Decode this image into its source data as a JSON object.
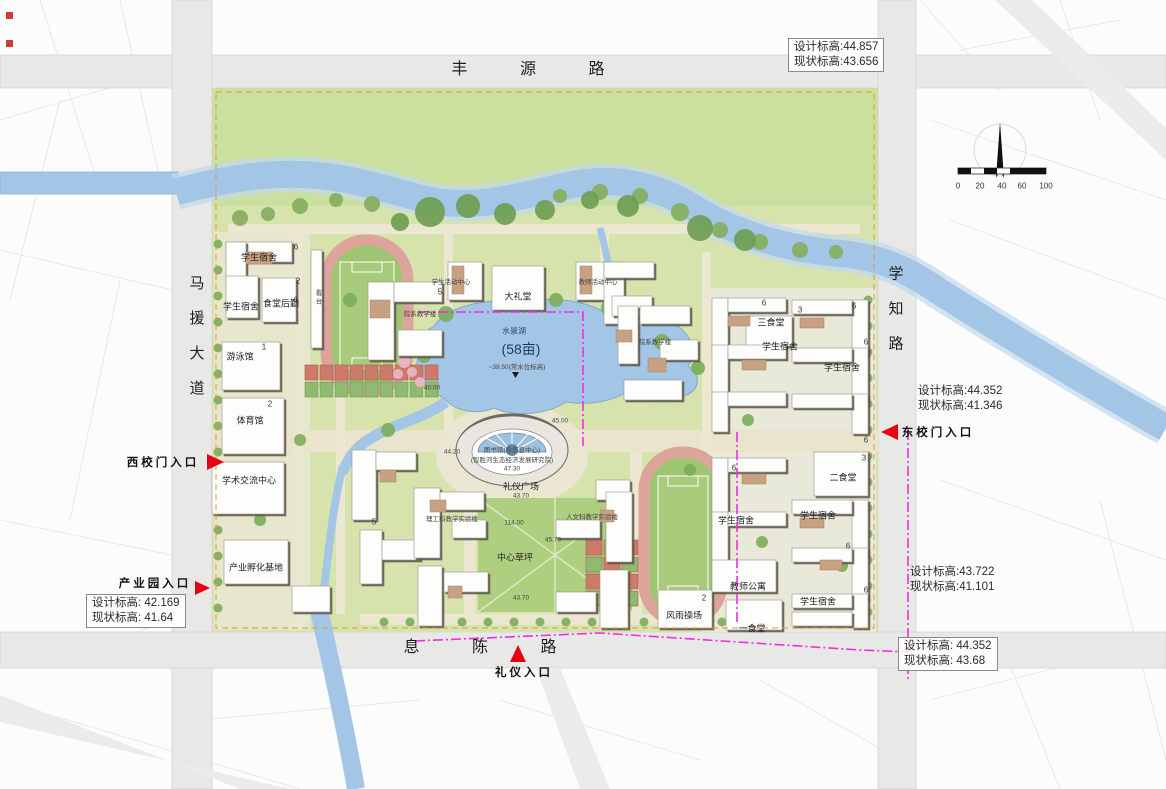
{
  "title": "校园总平面图",
  "colors": {
    "water": "#a4c6e6",
    "campus_green": "#d7e3ad",
    "lawn_green": "#cbdf9e",
    "track_red": "#dca49a",
    "field_green": "#a8cb7b",
    "building_tan": "#c8a183",
    "boundary_magenta": "#ee2fe2",
    "boundary_orange": "#e2953f",
    "arrow_red": "#e60012"
  },
  "roads": {
    "north": "丰 源 路",
    "west": "马援大道",
    "east": "学知路",
    "south": "息 陈 路"
  },
  "entrances": {
    "west": "西 校 门 入 口",
    "east": "东 校 门 入 口",
    "industry": "产 业 园 入 口",
    "ceremony": "礼 仪 入 口"
  },
  "lake": {
    "name": "水景湖",
    "area": "(58亩)",
    "level": "~39.50(常水位标高)"
  },
  "north_arrow": "north-arrow",
  "scale_ticks": [
    "0",
    "20",
    "40",
    "60",
    "100"
  ],
  "elevation_notes": [
    {
      "x": 788,
      "y": 38,
      "design": "设计标高:44.857",
      "current": "现状标高:43.656",
      "boxed": true
    },
    {
      "x": 918,
      "y": 384,
      "design": "设计标高:44.352",
      "current": "现状标高:41.346",
      "boxed": false
    },
    {
      "x": 910,
      "y": 565,
      "design": "设计标高:43.722",
      "current": "现状标高:41.101",
      "boxed": false
    },
    {
      "x": 898,
      "y": 637,
      "design": "设计标高: 44.352",
      "current": "现状标高: 43.68",
      "boxed": true
    },
    {
      "x": 86,
      "y": 594,
      "design": "设计标高: 42.169",
      "current": "现状标高: 41.64",
      "boxed": true
    }
  ],
  "map_labels": [
    {
      "name": "road-label-fengyuan",
      "text": "丰 源 路",
      "x": 540,
      "y": 67,
      "cls": "road-h"
    },
    {
      "name": "road-label-mayuan",
      "text": "马援大道",
      "x": 196,
      "y": 345,
      "cls": "road-v"
    },
    {
      "name": "road-label-xuezhi",
      "text": "学知路",
      "x": 895,
      "y": 318,
      "cls": "road-v"
    },
    {
      "name": "road-label-xichen",
      "text": "息 陈 路",
      "x": 492,
      "y": 645,
      "cls": "road-h"
    },
    {
      "name": "west-gate-label",
      "text": "西校门入口",
      "x": 163,
      "y": 462,
      "cls": "entrance"
    },
    {
      "name": "east-gate-label",
      "text": "东校门入口",
      "x": 938,
      "y": 432,
      "cls": "entrance"
    },
    {
      "name": "industry-gate-label",
      "text": "产业园入口",
      "x": 155,
      "y": 583,
      "cls": "entrance"
    },
    {
      "name": "ceremony-gate-label",
      "text": "礼仪入口",
      "x": 524,
      "y": 672,
      "cls": "entrance"
    },
    {
      "name": "lake-name-label",
      "text": "水景湖",
      "x": 514,
      "y": 331,
      "cls": "lake-name"
    },
    {
      "name": "lake-area-label",
      "text": "(58亩)",
      "x": 521,
      "y": 349,
      "cls": "lake-area"
    },
    {
      "name": "lake-level-label",
      "text": "~39.50(常水位标高)",
      "x": 517,
      "y": 366,
      "cls": "tiny"
    },
    {
      "name": "library-label",
      "text": "图书馆(含信息中心)",
      "x": 512,
      "y": 449,
      "cls": "tiny"
    },
    {
      "name": "institute-label",
      "text": "(智胜河生态经济发展研究院)",
      "x": 512,
      "y": 459,
      "cls": "tiny"
    },
    {
      "name": "spot-elevation",
      "text": "47.30",
      "x": 512,
      "y": 469,
      "cls": "tiny"
    },
    {
      "name": "ceremony-plaza-label",
      "text": "礼仪广场",
      "x": 521,
      "y": 486,
      "cls": "bl"
    },
    {
      "name": "spot-elevation",
      "text": "43.70",
      "x": 521,
      "y": 496,
      "cls": "tiny"
    },
    {
      "name": "dim-note",
      "text": "114.00",
      "x": 514,
      "y": 523,
      "cls": "tiny"
    },
    {
      "name": "spot-elevation",
      "text": "45.70",
      "x": 553,
      "y": 540,
      "cls": "tiny"
    },
    {
      "name": "central-lawn-label",
      "text": "中心草坪",
      "x": 515,
      "y": 557,
      "cls": "bl"
    },
    {
      "name": "spot-elevation",
      "text": "43.70",
      "x": 521,
      "y": 598,
      "cls": "tiny"
    },
    {
      "name": "spot-elevation",
      "text": "40.00",
      "x": 432,
      "y": 388,
      "cls": "tiny"
    },
    {
      "name": "spot-elevation",
      "text": "44.20",
      "x": 452,
      "y": 452,
      "cls": "tiny"
    },
    {
      "name": "spot-elevation",
      "text": "45.00",
      "x": 560,
      "y": 421,
      "cls": "tiny"
    },
    {
      "name": "building-label-dorm",
      "text": "学生宿舍",
      "x": 259,
      "y": 257,
      "cls": "bl"
    },
    {
      "name": "building-label-dorm",
      "text": "学生宿舍",
      "x": 241,
      "y": 306,
      "cls": "bl"
    },
    {
      "name": "building-label-canteen-logistics",
      "text": "食堂后勤",
      "x": 281,
      "y": 303,
      "cls": "bl"
    },
    {
      "name": "building-label-grandstand",
      "text": "看台",
      "x": 317,
      "y": 298,
      "cls": "tiny vert"
    },
    {
      "name": "building-label-natatorium",
      "text": "游泳馆",
      "x": 240,
      "y": 356,
      "cls": "bl"
    },
    {
      "name": "building-label-gymnasium",
      "text": "体育馆",
      "x": 250,
      "y": 420,
      "cls": "bl"
    },
    {
      "name": "building-label-academic-exchange",
      "text": "学术交流中心",
      "x": 249,
      "y": 480,
      "cls": "bl"
    },
    {
      "name": "building-label-incubator",
      "text": "产业孵化基地",
      "x": 256,
      "y": 567,
      "cls": "bl"
    },
    {
      "name": "building-label-student-activity",
      "text": "学生活动中心",
      "x": 451,
      "y": 281,
      "cls": "tiny"
    },
    {
      "name": "building-label-auditorium",
      "text": "大礼堂",
      "x": 518,
      "y": 296,
      "cls": "bl"
    },
    {
      "name": "building-label-teacher-activity",
      "text": "教师活动中心",
      "x": 598,
      "y": 281,
      "cls": "tiny"
    },
    {
      "name": "building-label-dept-teaching",
      "text": "院系教学楼",
      "x": 420,
      "y": 313,
      "cls": "tiny"
    },
    {
      "name": "building-label-dept-teaching",
      "text": "院系教学楼",
      "x": 655,
      "y": 341,
      "cls": "tiny"
    },
    {
      "name": "building-label-sci-teaching",
      "text": "理工科教学实验楼",
      "x": 452,
      "y": 518,
      "cls": "tiny"
    },
    {
      "name": "building-label-hum-teaching",
      "text": "人文科教学实验楼",
      "x": 592,
      "y": 516,
      "cls": "tiny"
    },
    {
      "name": "building-label-canteen3",
      "text": "三食堂",
      "x": 771,
      "y": 322,
      "cls": "bl"
    },
    {
      "name": "building-label-dorm",
      "text": "学生宿舍",
      "x": 780,
      "y": 346,
      "cls": "bl"
    },
    {
      "name": "building-label-dorm",
      "text": "学生宿舍",
      "x": 842,
      "y": 367,
      "cls": "bl"
    },
    {
      "name": "building-label-canteen2",
      "text": "二食堂",
      "x": 843,
      "y": 477,
      "cls": "bl"
    },
    {
      "name": "building-label-dorm",
      "text": "学生宿舍",
      "x": 818,
      "y": 515,
      "cls": "bl"
    },
    {
      "name": "building-label-dorm",
      "text": "学生宿舍",
      "x": 736,
      "y": 520,
      "cls": "bl"
    },
    {
      "name": "building-label-teacher-apartment",
      "text": "教师公寓",
      "x": 748,
      "y": 586,
      "cls": "bl"
    },
    {
      "name": "building-label-dorm",
      "text": "学生宿舍",
      "x": 818,
      "y": 601,
      "cls": "bl"
    },
    {
      "name": "building-label-canteen1",
      "text": "一食堂",
      "x": 752,
      "y": 628,
      "cls": "bl"
    },
    {
      "name": "building-label-sports-hall",
      "text": "风雨操场",
      "x": 684,
      "y": 615,
      "cls": "bl"
    },
    {
      "name": "floors-note",
      "text": "6",
      "x": 296,
      "y": 247,
      "cls": "num"
    },
    {
      "name": "floors-note",
      "text": "6",
      "x": 296,
      "y": 300,
      "cls": "num"
    },
    {
      "name": "floors-note",
      "text": "6",
      "x": 764,
      "y": 303,
      "cls": "num"
    },
    {
      "name": "floors-note",
      "text": "6",
      "x": 854,
      "y": 306,
      "cls": "num"
    },
    {
      "name": "floors-note",
      "text": "6",
      "x": 866,
      "y": 342,
      "cls": "num"
    },
    {
      "name": "floors-note",
      "text": "6",
      "x": 734,
      "y": 468,
      "cls": "num"
    },
    {
      "name": "floors-note",
      "text": "6",
      "x": 866,
      "y": 440,
      "cls": "num"
    },
    {
      "name": "floors-note",
      "text": "6",
      "x": 848,
      "y": 546,
      "cls": "num"
    },
    {
      "name": "floors-note",
      "text": "6",
      "x": 866,
      "y": 590,
      "cls": "num"
    },
    {
      "name": "floors-note",
      "text": "3",
      "x": 800,
      "y": 310,
      "cls": "num"
    },
    {
      "name": "floors-note",
      "text": "3",
      "x": 864,
      "y": 458,
      "cls": "num"
    },
    {
      "name": "floors-note",
      "text": "2",
      "x": 298,
      "y": 281,
      "cls": "num"
    },
    {
      "name": "floors-note",
      "text": "2",
      "x": 270,
      "y": 404,
      "cls": "num"
    },
    {
      "name": "floors-note",
      "text": "2",
      "x": 704,
      "y": 598,
      "cls": "num"
    },
    {
      "name": "floors-note",
      "text": "1",
      "x": 264,
      "y": 347,
      "cls": "num"
    },
    {
      "name": "floors-note",
      "text": "5",
      "x": 440,
      "y": 292,
      "cls": "num"
    },
    {
      "name": "floors-note",
      "text": "5",
      "x": 374,
      "y": 522,
      "cls": "num"
    },
    {
      "name": "scale-tick",
      "text": "0",
      "x": 958,
      "y": 186,
      "cls": "num"
    },
    {
      "name": "scale-tick",
      "text": "20",
      "x": 980,
      "y": 186,
      "cls": "num"
    },
    {
      "name": "scale-tick",
      "text": "40",
      "x": 1002,
      "y": 186,
      "cls": "num"
    },
    {
      "name": "scale-tick",
      "text": "60",
      "x": 1022,
      "y": 186,
      "cls": "num"
    },
    {
      "name": "scale-tick",
      "text": "100",
      "x": 1046,
      "y": 186,
      "cls": "num"
    }
  ]
}
